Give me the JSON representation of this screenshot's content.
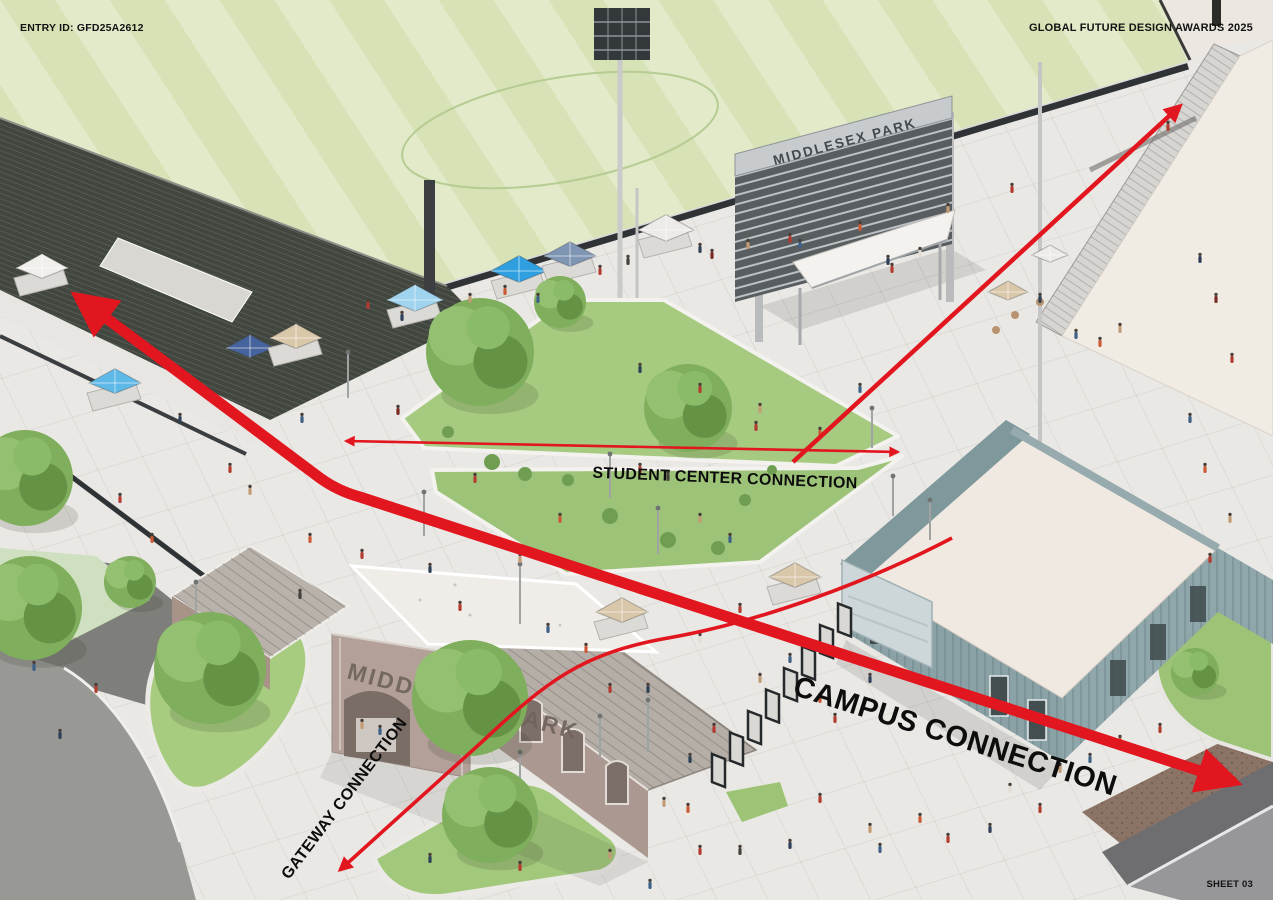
{
  "sheet": {
    "entry_id": "ENTRY ID: GFD25A2612",
    "award_title": "GLOBAL FUTURE DESIGN AWARDS 2025",
    "sheet_number": "SHEET 03"
  },
  "annotations": {
    "campus_connection": "CAMPUS CONNECTION",
    "student_center_connection": "STUDENT CENTER CONNECTION",
    "gateway_connection": "GATEWAY CONNECTION"
  },
  "signs": {
    "scoreboard": "MIDDLESEX PARK",
    "gate": "MIDDLESEX PARK"
  },
  "colors": {
    "arrow_red": "#e2161f",
    "field_green": "#d7e2b6",
    "lawn_green": "#a3c97d",
    "concrete": "#eae8e4",
    "building_teal": "#8aa2a6",
    "building_tan": "#b2a099",
    "roof_cream": "#f0ebe3",
    "canopy_blue": "#2f9fe0",
    "dark_structure": "#41463f"
  }
}
